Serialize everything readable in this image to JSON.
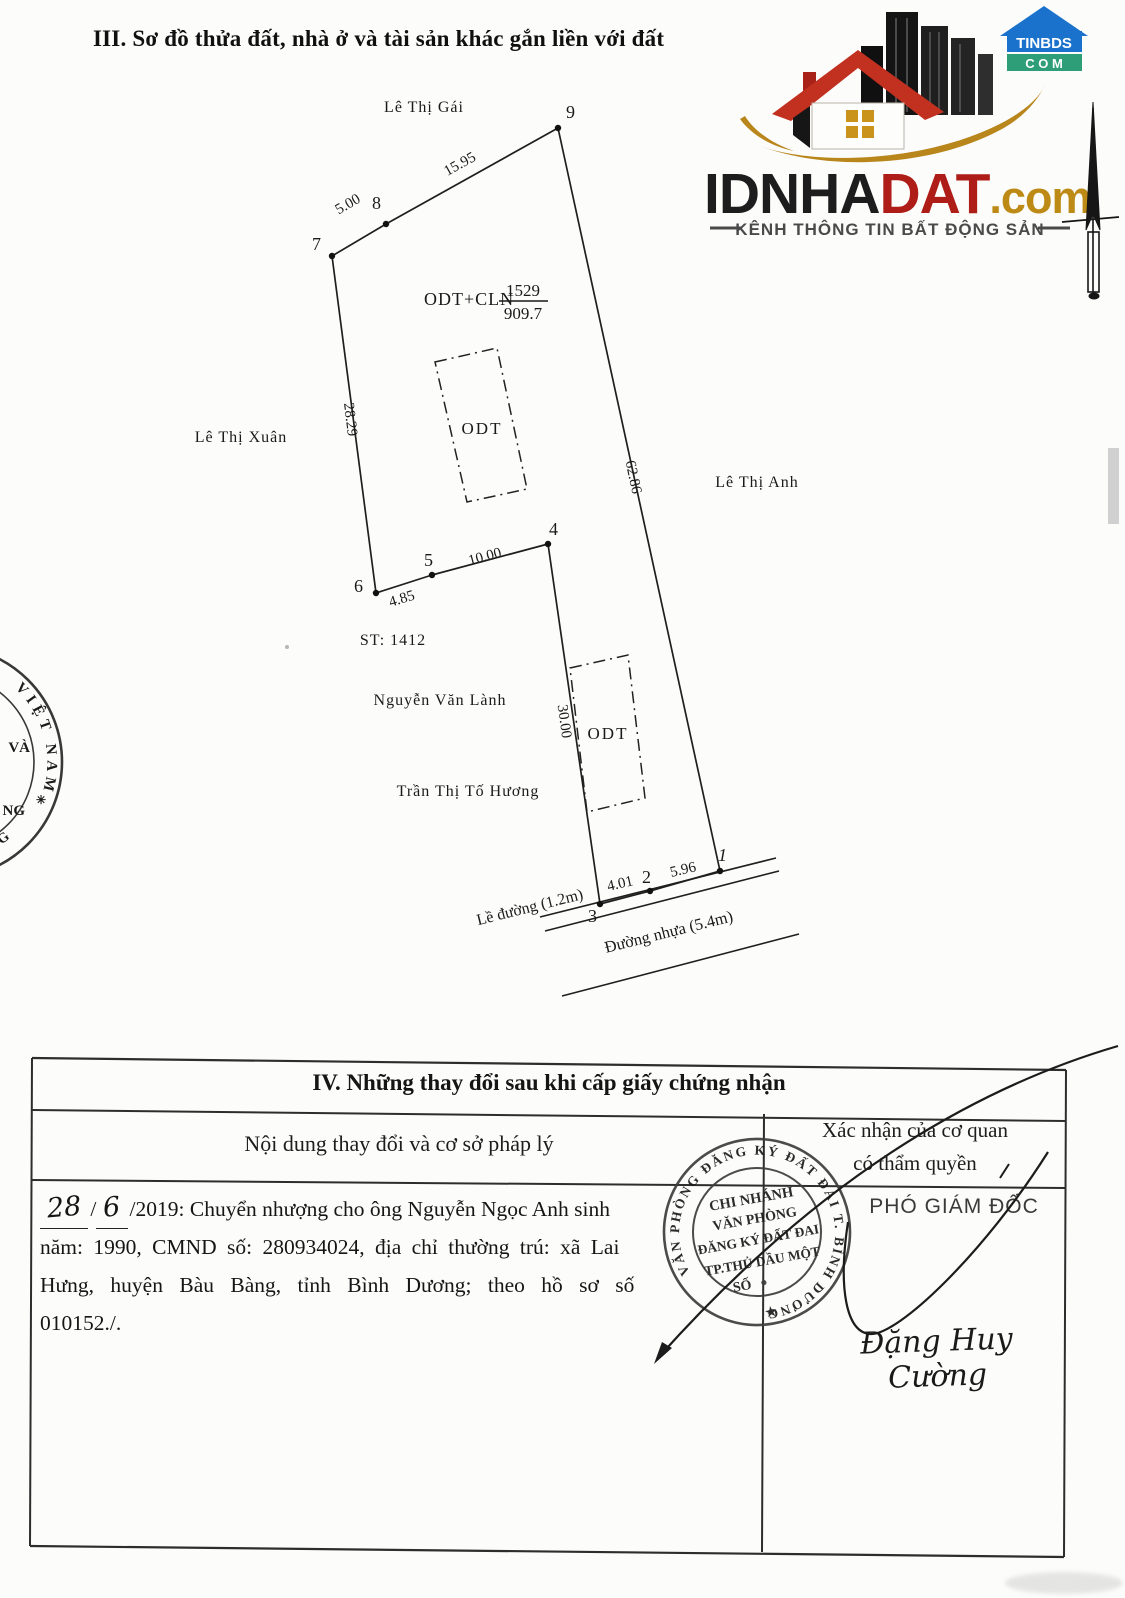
{
  "document": {
    "section3_title": "III. Sơ đồ thửa đất, nhà ở và tài sản khác gắn liền với đất",
    "section4": {
      "title": "IV. Những thay đổi sau khi cấp giấy chứng nhận",
      "col_content": "Nội dung thay đổi và cơ sở pháp lý",
      "col_confirm_line1": "Xác nhận của cơ quan",
      "col_confirm_line2": "có thẩm quyền",
      "entry": {
        "handwritten_day": "28",
        "handwritten_month": "6",
        "line1_rest": "/2019: Chuyển nhượng cho ông Nguyễn Ngọc Anh sinh",
        "line2": "năm: 1990, CMND số: 280934024, địa chỉ thường trú: xã Lai",
        "line3": "Hưng, huyện Bàu Bàng, tỉnh Bình Dương; theo hồ sơ số",
        "line4": "010152./."
      },
      "approver_title": "PHÓ GIÁM ĐỐC",
      "signature_name": "Đặng Huy Cường",
      "stamp": {
        "ring_text": "VĂN PHÒNG ĐĂNG KÝ ĐẤT ĐAI  T. BÌNH DƯƠNG",
        "line1": "CHI NHÁNH",
        "line2": "VĂN PHÒNG",
        "line3": "ĐĂNG KÝ ĐẤT ĐAI",
        "line4": "TP.THỦ DẦU MỘT",
        "line5": "SỐ",
        "star": "★"
      }
    }
  },
  "diagram": {
    "parcel_use": "ODT+CLN",
    "parcel_number": "1529",
    "parcel_area": "909.7",
    "sheet_note": "ST: 1412",
    "house_label_1": "ODT",
    "house_label_2": "ODT",
    "neighbor_north": "Lê Thị Gái",
    "neighbor_west": "Lê Thị Xuân",
    "neighbor_east": "Lê Thị Anh",
    "neighbor_south_1": "Nguyễn Văn Lành",
    "neighbor_south_2": "Trần Thị Tố Hương",
    "road_shoulder": "Lề đường (1.2m)",
    "road_name": "Đường nhựa (5.4m)",
    "lengths": {
      "seg_8_9": "15.95",
      "seg_7_8": "5.00",
      "seg_7_6": "28.29",
      "seg_9_1": "62.86",
      "seg_6_5": "4.85",
      "seg_5_4": "10.00",
      "seg_4_3": "30.00",
      "seg_3_2": "4.01",
      "seg_2_1": "5.96"
    },
    "vertices": {
      "v1": "1",
      "v2": "2",
      "v3": "3",
      "v4": "4",
      "v5": "5",
      "v6": "6",
      "v7": "7",
      "v8": "8",
      "v9": "9"
    }
  },
  "left_stamp": {
    "arc_top": "VIỆT NAM",
    "frag1": "VÀ",
    "frag2": "NG",
    "arc_bottom": "DUONG",
    "star": "✳"
  },
  "logo": {
    "brand_black": "IDNHA",
    "brand_red": "DAT",
    "brand_gold": ".com",
    "tagline": "KÊNH THÔNG TIN BẤT ĐỘNG SẢN",
    "badge_line1": "TINBDS",
    "badge_line2": "C O M",
    "colors": {
      "brand_red": "#ae1d17",
      "brand_gold": "#bd8a15",
      "brand_dark": "#1d1d1d",
      "badge_blue": "#1b72cc",
      "badge_green": "#2e9e78"
    }
  }
}
